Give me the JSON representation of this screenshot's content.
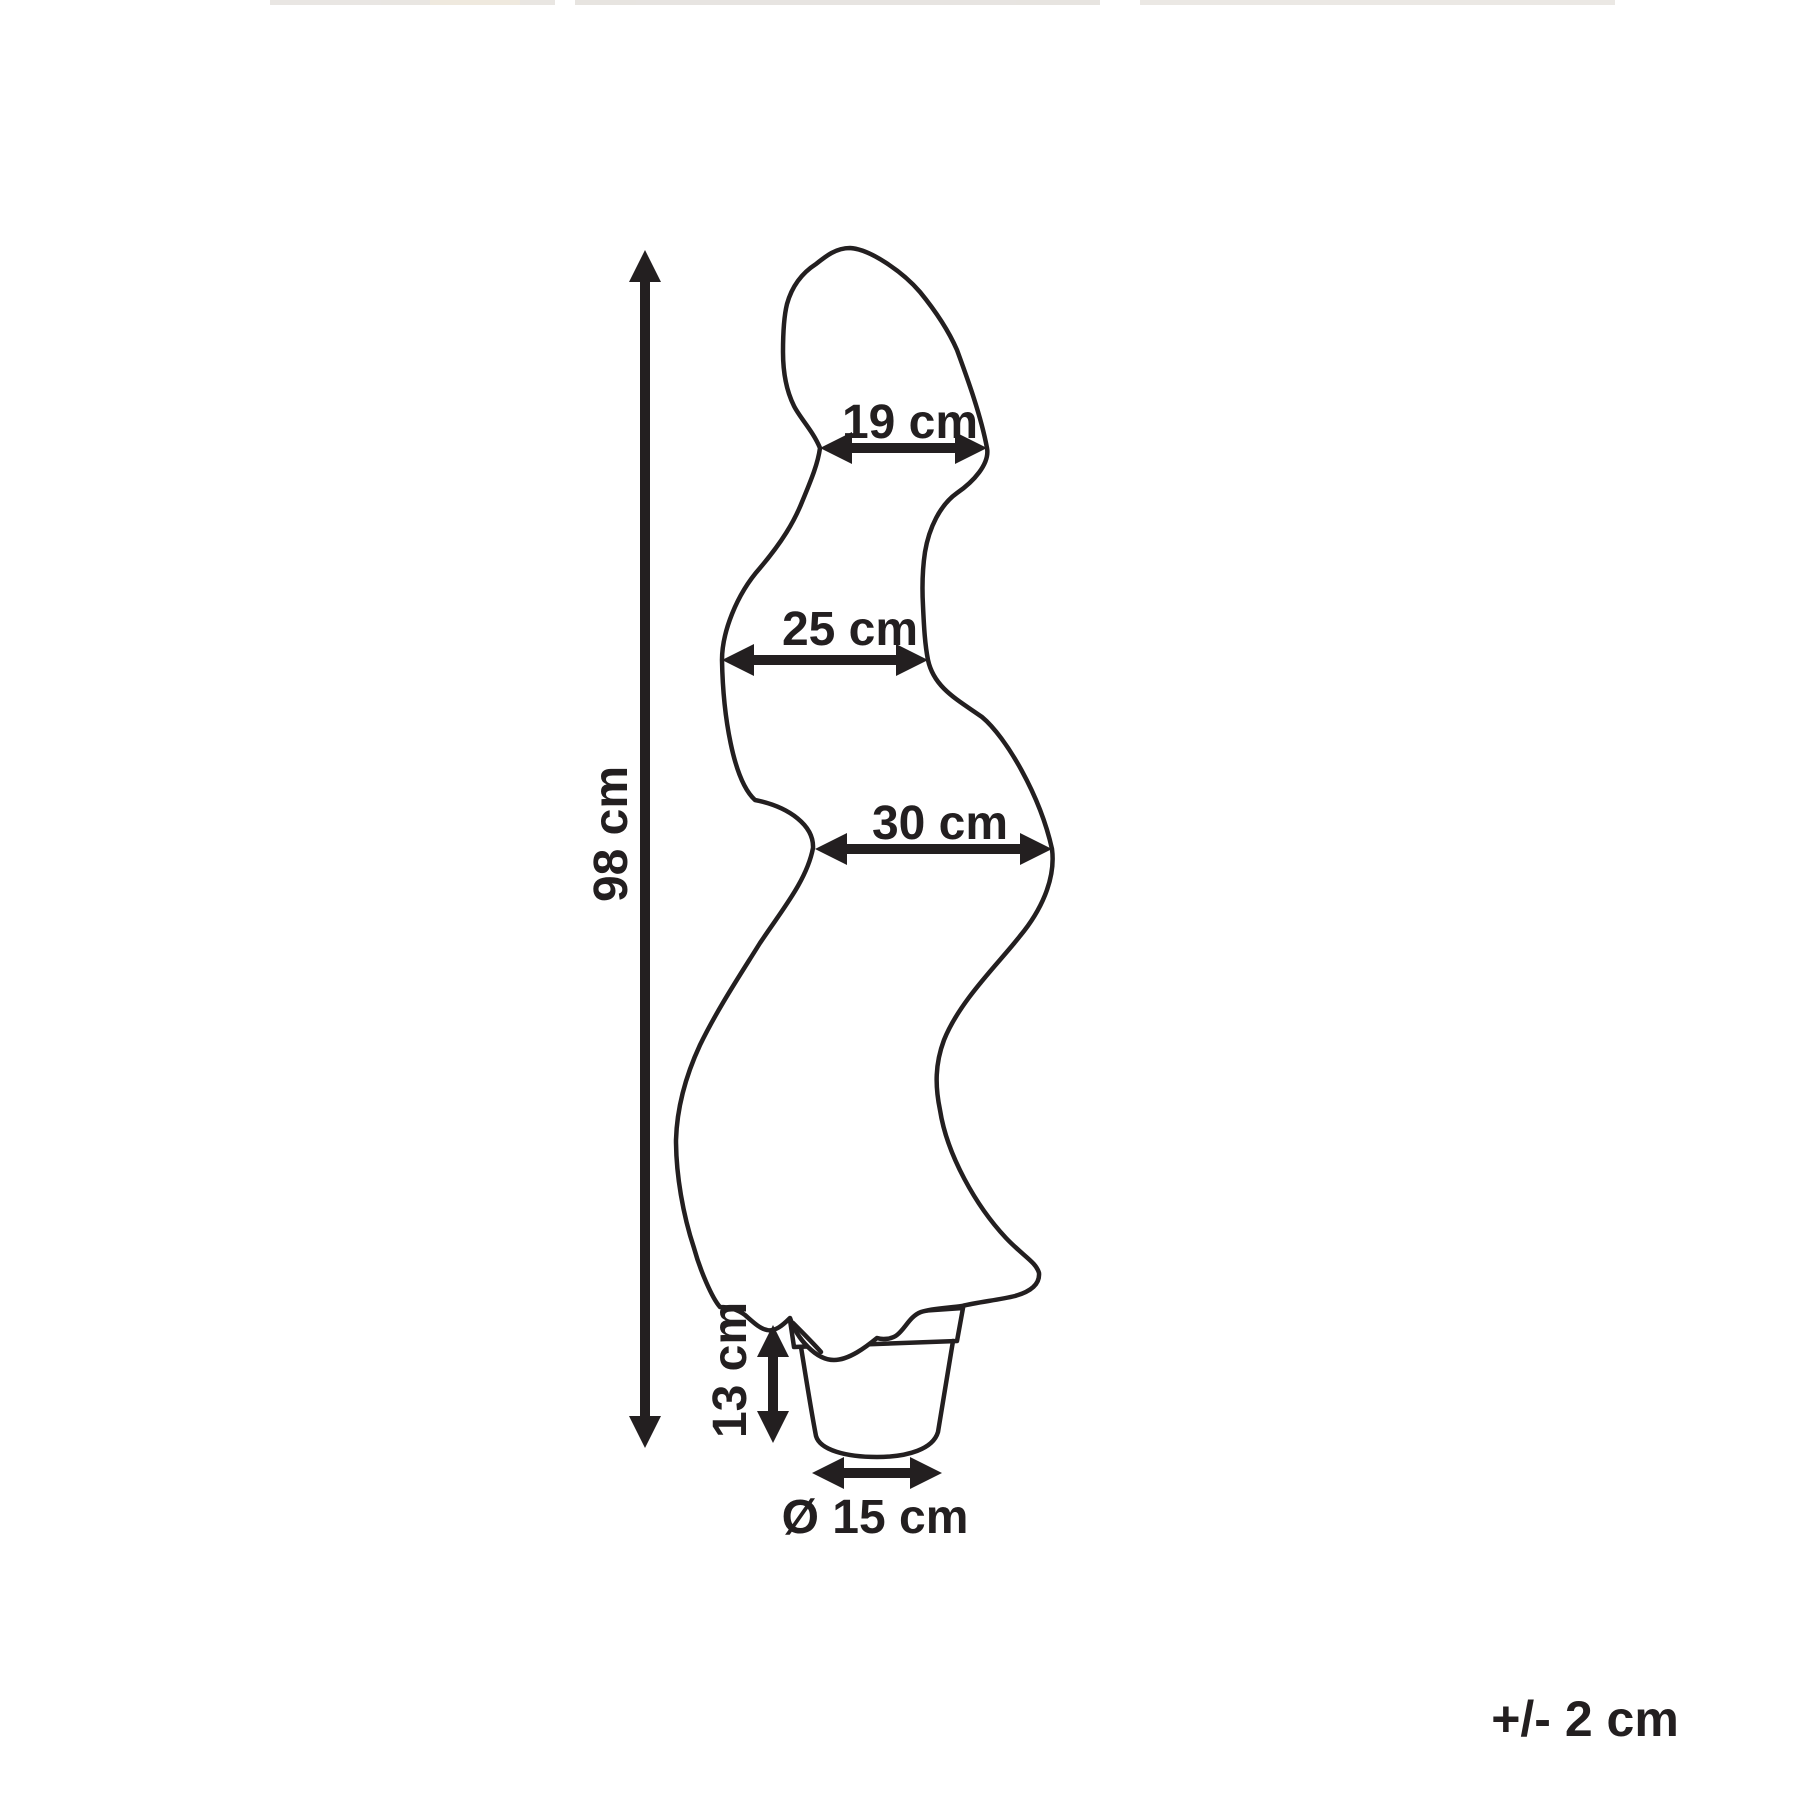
{
  "canvas": {
    "background": "#ffffff",
    "line_color": "#231f20",
    "text_color": "#231f20"
  },
  "diagram": {
    "type": "product-dimension-drawing",
    "subject": "spiral topiary plant in a round flower pot",
    "measurements": {
      "top_width": {
        "label": "19 cm"
      },
      "middle_width": {
        "label": "25 cm"
      },
      "bottom_width": {
        "label": "30 cm"
      },
      "total_height": {
        "label": "98 cm"
      },
      "pot_height": {
        "label": "13 cm"
      },
      "pot_diameter": {
        "label": "Ø 15 cm"
      }
    },
    "tolerance_note": "+/- 2 cm",
    "arrows": [
      {
        "name": "total-height-arrow",
        "orientation": "vertical",
        "measures": "98 cm"
      },
      {
        "name": "top-width-arrow",
        "orientation": "horizontal",
        "measures": "19 cm"
      },
      {
        "name": "middle-width-arrow",
        "orientation": "horizontal",
        "measures": "25 cm"
      },
      {
        "name": "bottom-width-arrow",
        "orientation": "horizontal",
        "measures": "30 cm"
      },
      {
        "name": "pot-height-arrow",
        "orientation": "vertical",
        "measures": "13 cm"
      },
      {
        "name": "pot-diameter-arrow",
        "orientation": "horizontal",
        "measures": "Ø 15 cm"
      }
    ]
  }
}
